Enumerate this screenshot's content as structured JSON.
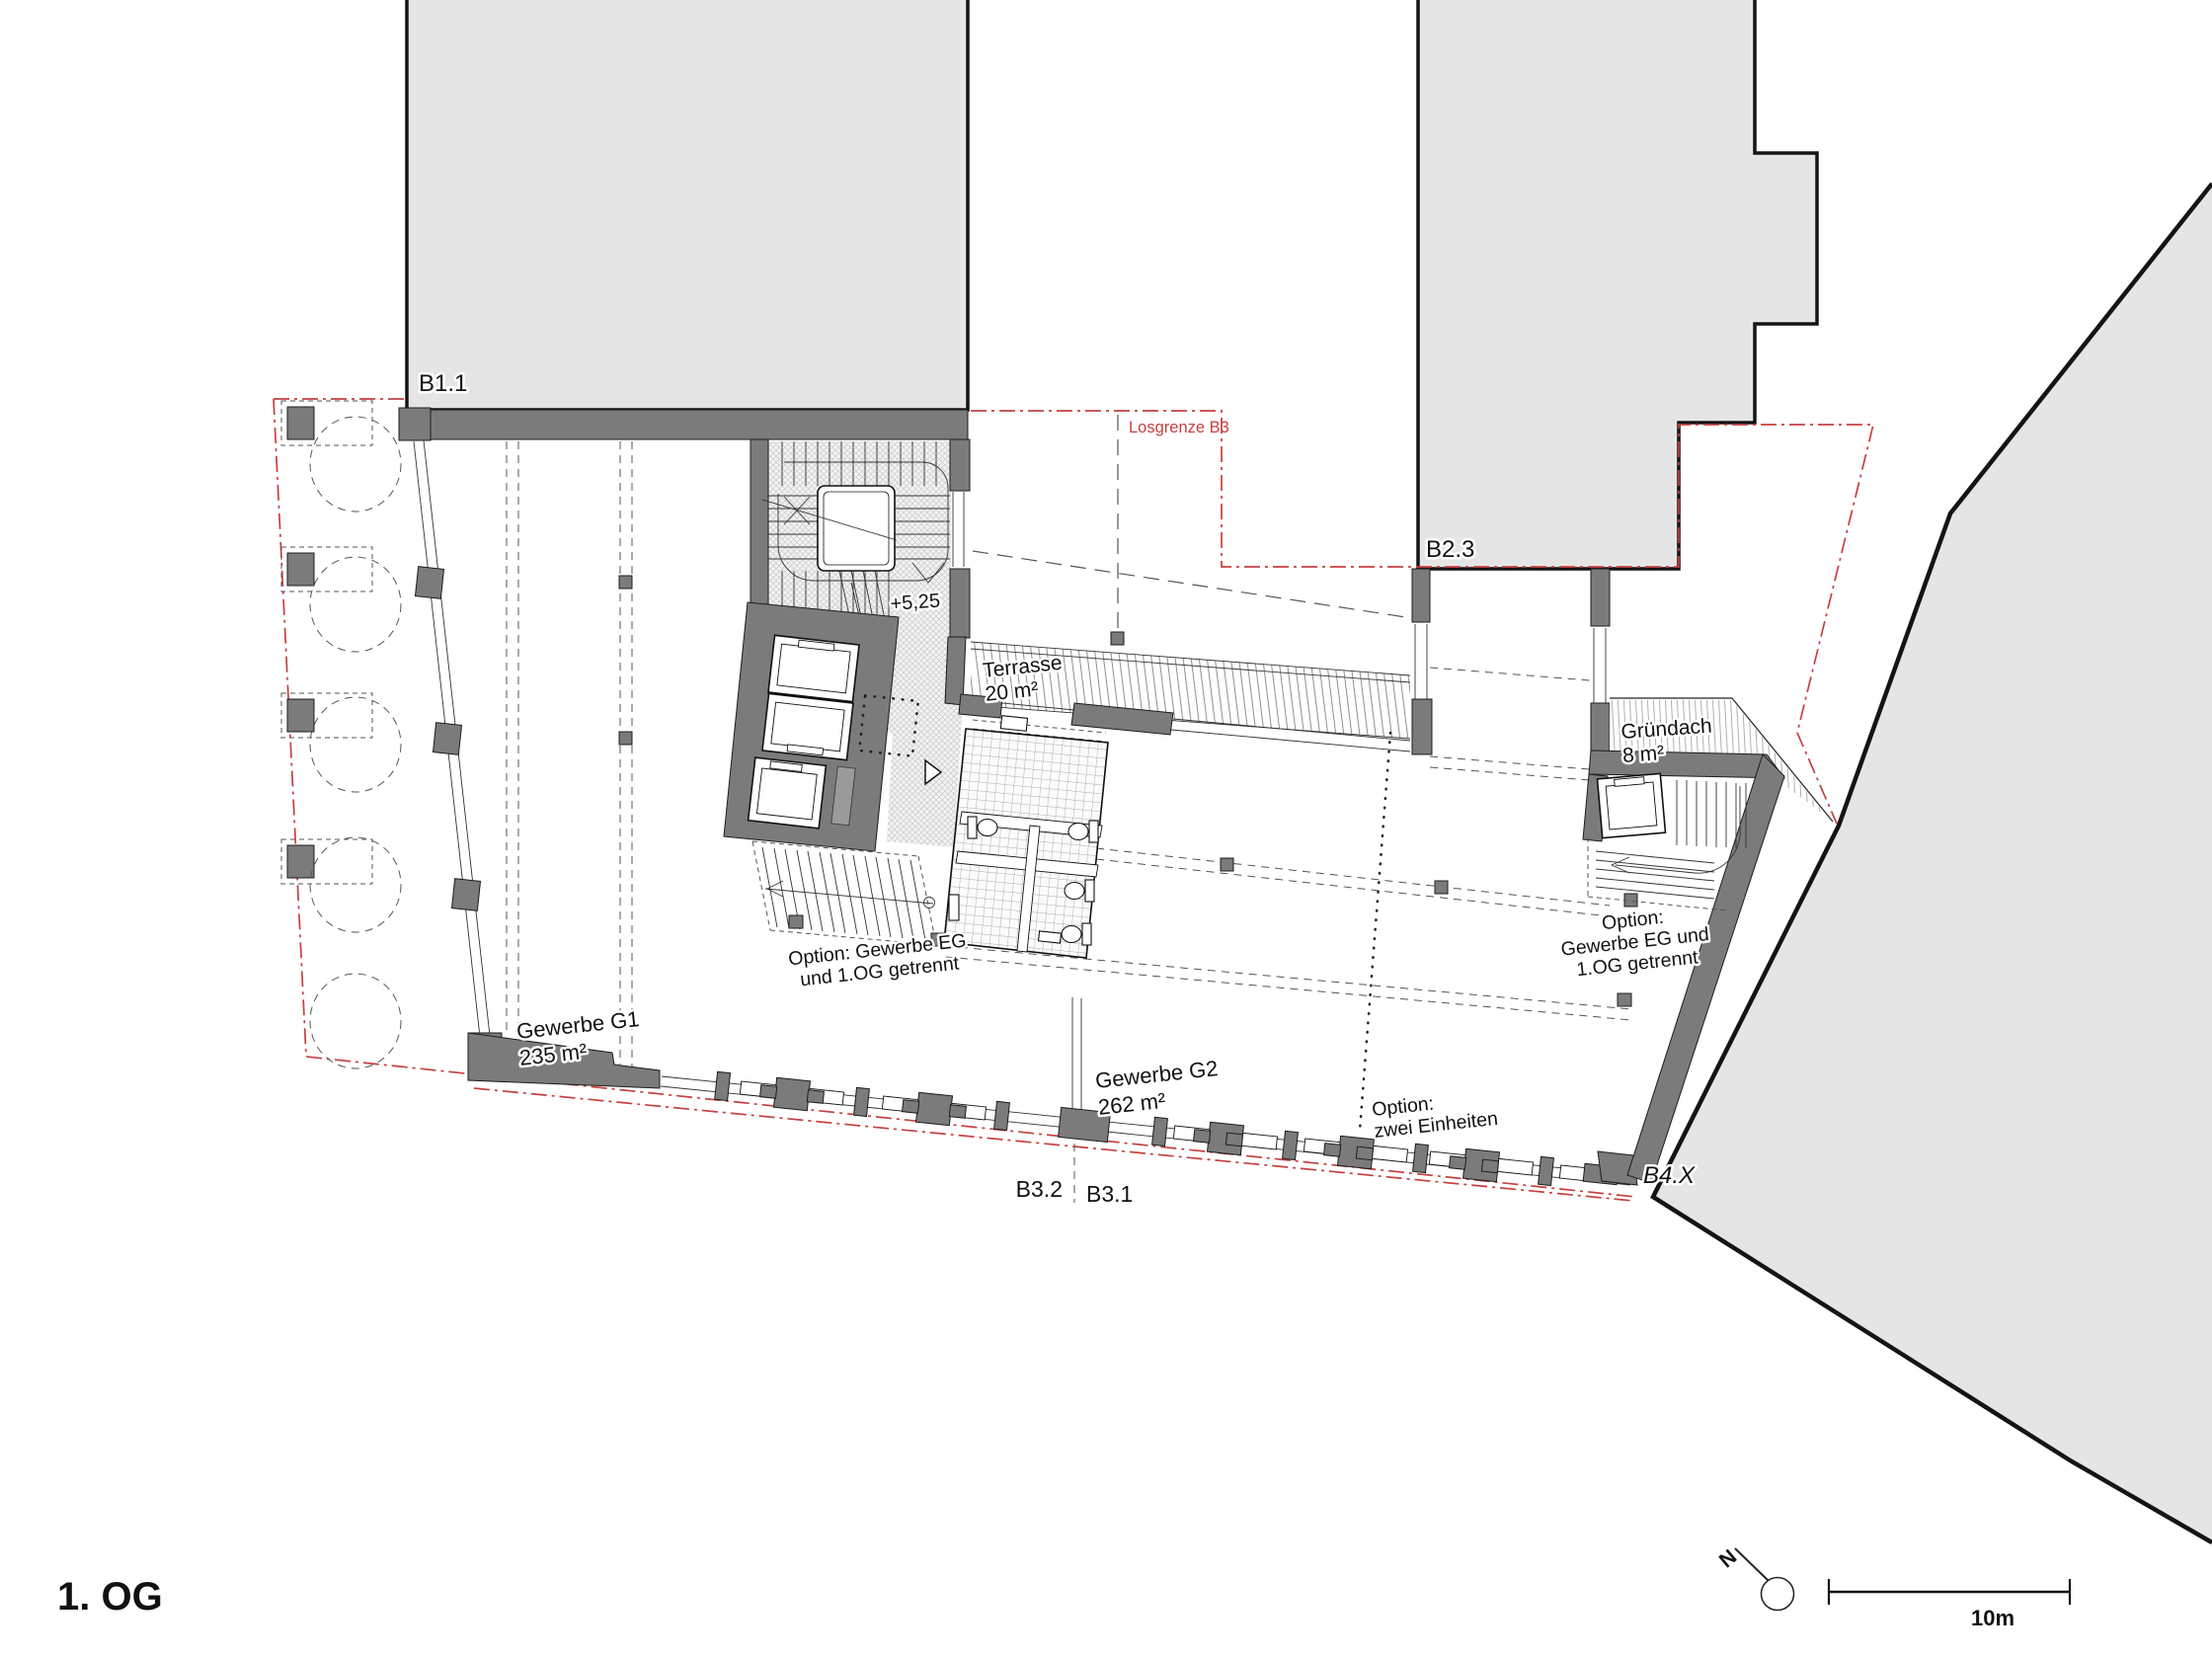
{
  "title": "1. OG",
  "colors": {
    "red_boundary": "#c64040",
    "building_fill": "#e5e5e5",
    "wall_fill": "#7b7b7b"
  },
  "buildings": {
    "b11": {
      "label": "B1.1"
    },
    "b23": {
      "label": "B2.3"
    },
    "b4x": {
      "label": "B4.X"
    }
  },
  "boundary": {
    "label": "Losgrenze B3"
  },
  "rooms": {
    "terrasse": {
      "label": "Terrasse",
      "area": "20 m²"
    },
    "gruendach": {
      "label": "Gründach",
      "area": "8 m²"
    },
    "g1": {
      "label": "Gewerbe G1",
      "area": "235 m²"
    },
    "g2": {
      "label": "Gewerbe G2",
      "area": "262 m²"
    }
  },
  "levels": {
    "stair_landing": "+5,25"
  },
  "options": {
    "left": {
      "line1": "Option: Gewerbe EG",
      "line2": "und 1.OG getrennt"
    },
    "middle": {
      "line1": "Option:",
      "line2": "zwei Einheiten"
    },
    "right": {
      "line1": "Option:",
      "line2": "Gewerbe EG und",
      "line3": "1.OG getrennt"
    }
  },
  "section_markers": {
    "left": "B3.2",
    "right": "B3.1"
  },
  "scale": {
    "label": "10m"
  },
  "north": {
    "label": "N"
  },
  "floor_title": "1. OG"
}
